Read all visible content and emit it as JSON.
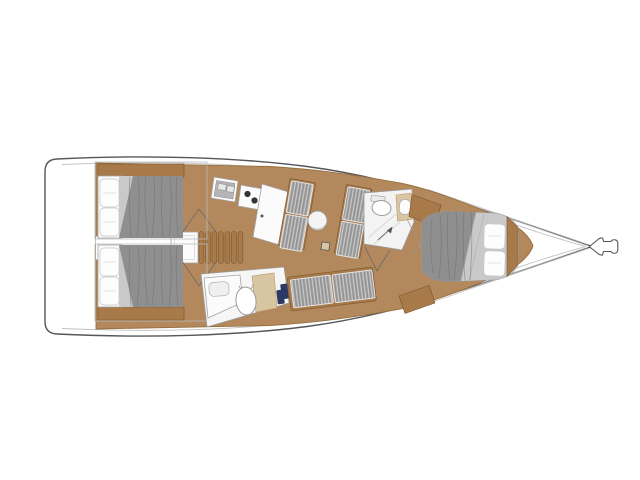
{
  "image": {
    "kind": "yacht-interior-floor-plan",
    "view": "top-down, bow pointing right",
    "visible_text": ""
  },
  "palette": {
    "background": "#ffffff",
    "hull_stroke": "#55565a",
    "inner_line": "#c2c2c2",
    "wood_floor": "#b2885c",
    "wood_floor_edge": "#97713f",
    "wood_trim": "#a87a4a",
    "wood_trim_dark": "#7a5530",
    "mattress_gray": "#8f8f8f",
    "mattress_streak": "#696969",
    "sheet_light": "#c9c9c9",
    "cushion_gray": "#9d9d9d",
    "white_furniture": "#fbfbfb",
    "furniture_stroke": "#a3a3a3",
    "counter_tan": "#d8c6a2",
    "accent_navy": "#2c3a63"
  },
  "components": {
    "hull": "sailboat hull with bowsprit",
    "aft_cabin_top": "aft double cabin (port side shown top-left)",
    "aft_cabin_bottom": "aft double cabin (starboard side shown bottom-left)",
    "companionway": "companionway steps and engine box",
    "galley": "galley: double sink, two-burner stove, counter",
    "salon": "salon settees, round table, mast post",
    "mid_head": "head with toilet, basin and shower",
    "lower_head": "second head with toilet, basin and shower",
    "bottom_settee": "straight salon settee",
    "forward_cabin": "forward cabin with tapered double berth"
  }
}
